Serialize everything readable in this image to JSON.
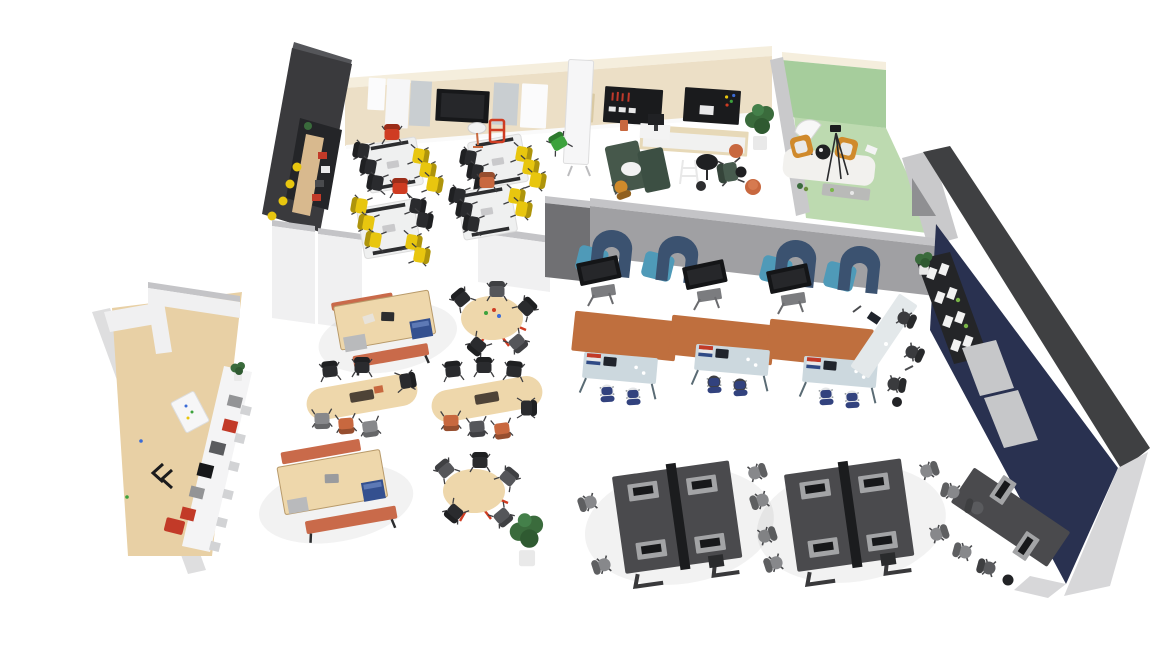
{
  "meta": {
    "type": "3D isometric office floor plan render",
    "background": "#ffffff",
    "canvas": {
      "width": 1166,
      "height": 656
    }
  },
  "colors": {
    "wall_beige": "#ecdfc6",
    "wall_beige_cap": "#f5eedd",
    "wall_dark": "#3a3a3d",
    "wall_dark2": "#242528",
    "wall_graphite": "#3f4042",
    "wall_navy": "#293150",
    "wall_gray": "#a0a0a3",
    "wall_gray_cap": "#c4c4c7",
    "wall_gray_dark": "#707073",
    "wall_white": "#f0f0f1",
    "wall_white_side": "#dededf",
    "wall_gray_light": "#d7d7d9",
    "green_wall": "#a6cd9c",
    "green_floor": "#bddab0",
    "partition_gray": "#c9c9cb",
    "wood_floor": "#e8d0a5",
    "wood_counter": "#d8b98e",
    "table_white": "#eff0f0",
    "table_wood": "#eed7ab",
    "bench_orange": "#c96a4a",
    "bin_blue": "#34508f",
    "rug": "#bf6f3e",
    "desk_light": "#ccd8de",
    "sofa_dark": "#3b5270",
    "sofa_teal": "#4f9ab8",
    "chair_yellow": "#e8c60f",
    "chair_black": "#2a2b2e",
    "chair_gray": "#87888b",
    "chair_orange": "#c8683f",
    "chair_red": "#cf3c22",
    "chair_green": "#3da23d",
    "chair_blue_seat": "#32427e",
    "armchair_mustard": "#d08a2c",
    "booth_green": "#46584b",
    "bench_desk": "#4a4a4d",
    "tray_gray": "#a3a4a6",
    "screen_black": "#17181a",
    "board_black": "#1a1b1d",
    "board_tan": "#d9c9a3",
    "appliance_red": "#c23a28",
    "appliance_gray": "#939496",
    "plant_green": "#3a6b3c",
    "pot_white": "#e9e9e9",
    "binder_white": "#f2f2f2",
    "locker_gray": "#c6c7c9"
  },
  "zones": [
    {
      "id": "training-room",
      "label": "training room",
      "items": [
        "4 white training tables",
        "yellow stack chairs",
        "black stack chairs",
        "red accent chairs",
        "media wall with display and whiteboards",
        "mobile flipchart",
        "green chair",
        "orange step stool",
        "projector stand"
      ]
    },
    {
      "id": "coffee-bar",
      "label": "coffee bar nook",
      "items": [
        "dark alcove wall",
        "wood bar counter",
        "yellow bar stools",
        "shelf with supplies"
      ]
    },
    {
      "id": "collab-lounge",
      "label": "collaboration lounge",
      "items": [
        "2 black pin boards",
        "tan pin board",
        "wood sideboard",
        "monitor desk",
        "green acoustic booth with table",
        "mustard task chair",
        "bistro table",
        "step ladder",
        "green lounge chair",
        "2 orange poufs",
        "potted plant"
      ]
    },
    {
      "id": "studio-room",
      "label": "green studio room",
      "items": [
        "2 orange armchairs",
        "round side table",
        "white shag rug",
        "camera tripod",
        "light umbrella",
        "gray low table"
      ]
    },
    {
      "id": "focus-row",
      "label": "focus row",
      "items": [
        "4 blue acoustic high-back sofas",
        "3 mobile TV carts",
        "3 terracotta rugs",
        "3 light desks with laptops",
        "6 blue-seat task chairs",
        "standing-height table",
        "3 dark chairs",
        "waste bin"
      ]
    },
    {
      "id": "cafe",
      "label": "cafe area",
      "items": [
        "2 wood tables with storage bins and orange benches",
        "2 oval tables",
        "2 round tables with red bases",
        "black, gray and orange chairs",
        "floor plant"
      ]
    },
    {
      "id": "kitchen-galley",
      "label": "kitchen galley",
      "items": [
        "wood wall panel",
        "white counter run",
        "red appliances",
        "gray appliances",
        "black coffee machine",
        "whiteboard",
        "plant"
      ]
    },
    {
      "id": "open-office",
      "label": "open office",
      "items": [
        "2 four-person bench desk clusters",
        "black desk dividers",
        "monitors",
        "gray task chairs",
        "4-person wall desk on navy wall",
        "storage shelf with white binders",
        "2 gray lockers",
        "shelf plant",
        "waste bin"
      ]
    }
  ]
}
